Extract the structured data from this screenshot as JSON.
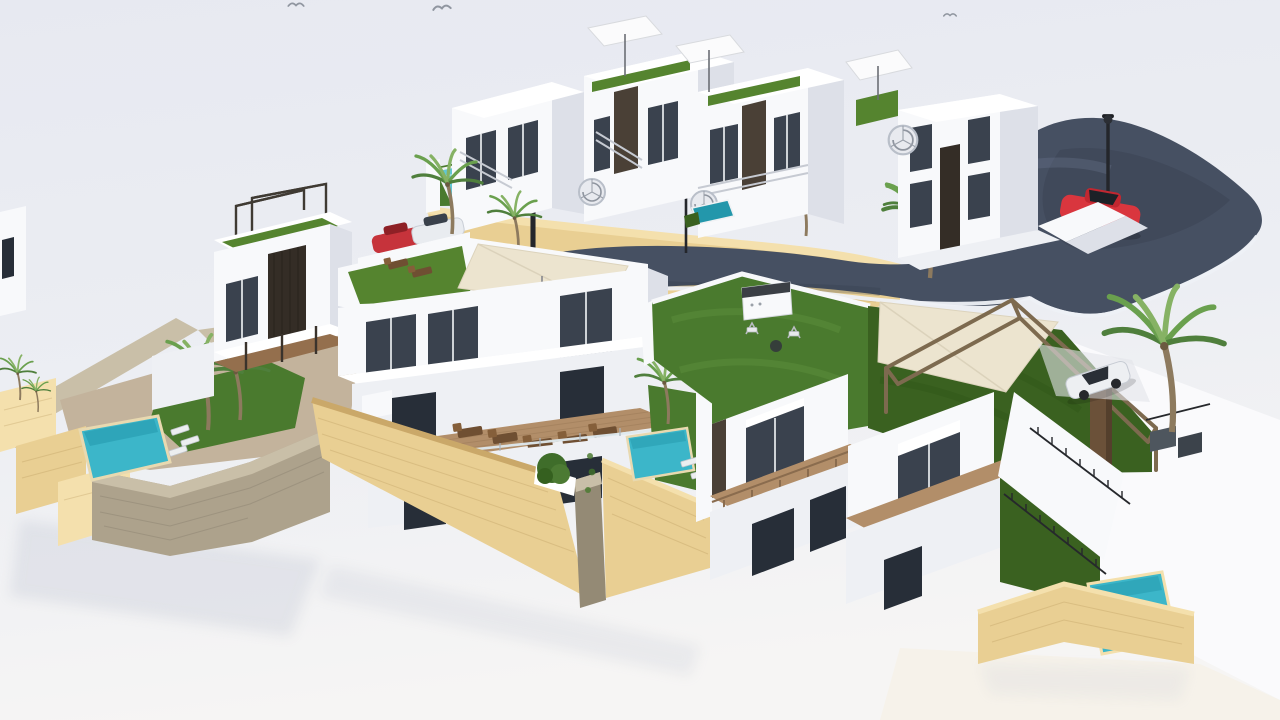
{
  "meta": {
    "title": "Aerial 3D rendering of a hillside villa development",
    "description": "Photorealistic architectural 3D render, aerial view: white modern villas and townhouses with rooftop terraces, artificial-grass roof gardens, private plunge pools, wooden sun decks with loungers, sandstone and grey stone retaining walls, palm trees, white parasols, a beige shade sail on a timber pergola, external spiral staircases, street lamps, and a curved dark asphalt road with a red car; pale off-white ground, no visible text."
  },
  "colors": {
    "background_top": "#e8eaf1",
    "background_bottom": "#f6f5f4",
    "villa_white": "#f8f9fb",
    "villa_shade": "#dde0e8",
    "road_asphalt": "#465062",
    "pool_water": "#3cb6c9",
    "pool_light": "#62c7d4",
    "pool_deep": "#2397ab",
    "lawn_green": "#4a7a2e",
    "lawn_dark": "#3a6120",
    "roof_turf": "#55842f",
    "stone_tan": "#e9cf93",
    "stone_tan_light": "#f4e0ad",
    "stone_gray": "#ada28c",
    "deck_wood": "#b28e69",
    "canopy_cream": "#ece4cf",
    "car_red": "#d9363e",
    "car_white": "#edeff2",
    "palm_green": "#5d8f46",
    "dark_panel": "#4a4036",
    "lamp_black": "#24262b"
  },
  "objects": {
    "villas_count": 9,
    "pools_count": 6,
    "palm_trees_count": 14,
    "parasols_count": 3,
    "street_lamps_count": 4,
    "birds_count": 3,
    "cars": [
      "red car driving on road",
      "red car parked at carport",
      "white car parked at carport",
      "white car in right driveway"
    ],
    "features": [
      "roof gardens with artificial turf",
      "beige shade sail on timber pergola",
      "spiral staircases",
      "wooden sun decks with brown loungers",
      "barbecue station on lawn terrace",
      "stone retaining walls",
      "outdoor stairs with dark railings"
    ]
  }
}
